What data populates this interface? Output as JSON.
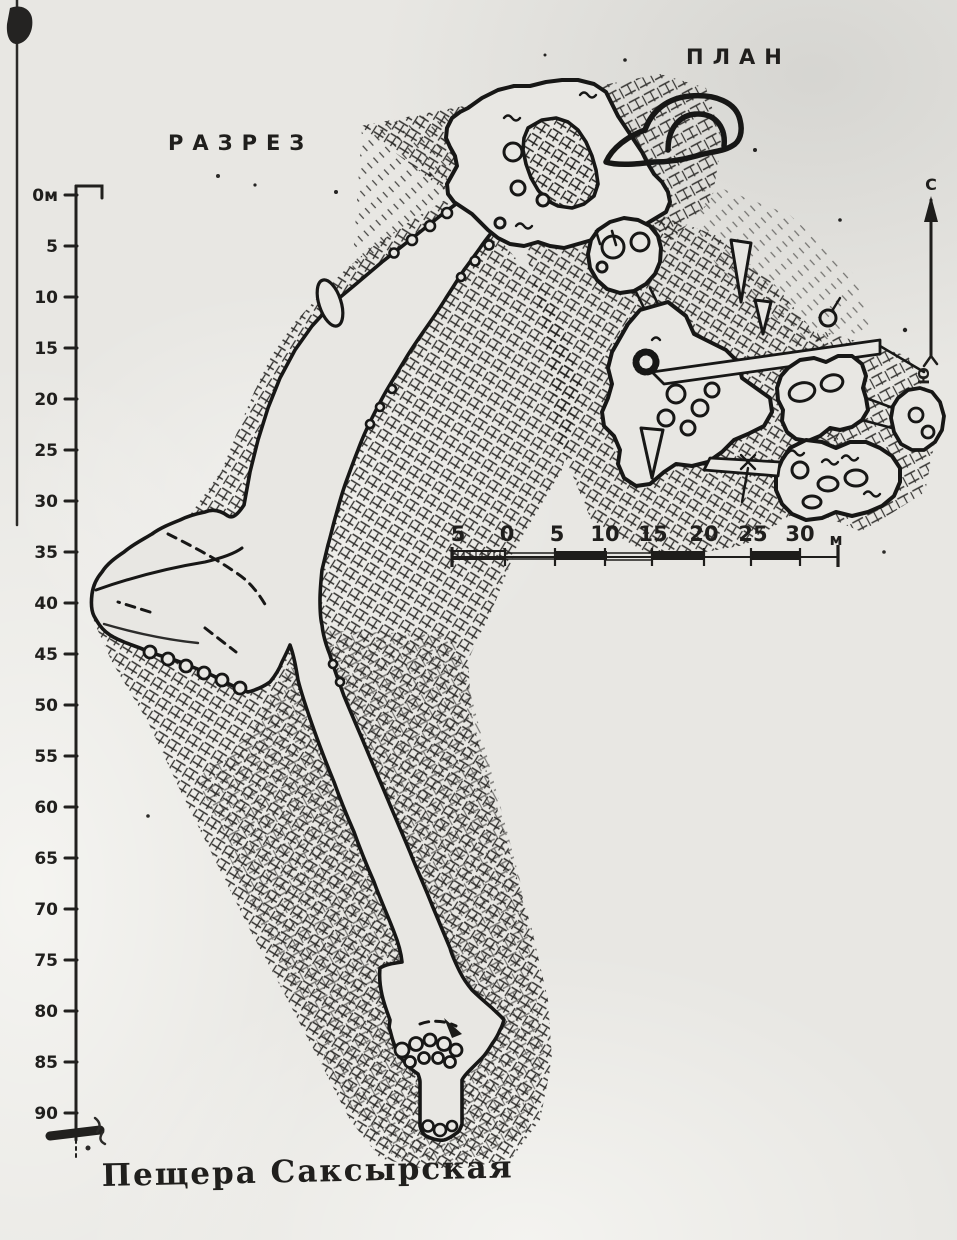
{
  "colors": {
    "paper": "#e8e7e3",
    "ink": "#1b1b19"
  },
  "labels": {
    "section": "РАЗРЕЗ",
    "plan": "ПЛАН"
  },
  "north_arrow": {
    "north_label": "С",
    "south_label": "Ю"
  },
  "depth_scale": {
    "ticks": [
      "0м",
      "5",
      "10",
      "15",
      "20",
      "25",
      "30",
      "35",
      "40",
      "45",
      "50",
      "55",
      "60",
      "65",
      "70",
      "75",
      "80",
      "85",
      "90"
    ]
  },
  "scale_bar": {
    "tick_labels": [
      "5",
      "0",
      "5",
      "10",
      "15",
      "20",
      "25",
      "30"
    ],
    "unit_label": "м"
  },
  "caption": {
    "title": "Пещера Саксырская"
  },
  "symbols": {
    "entrance_arch": "cave-entrance-arch-icon",
    "rock_hatching": "bedrock-cross-hatch",
    "boulders": "breakdown-boulder-circles",
    "north_line": "north-south-survey-arrow"
  }
}
